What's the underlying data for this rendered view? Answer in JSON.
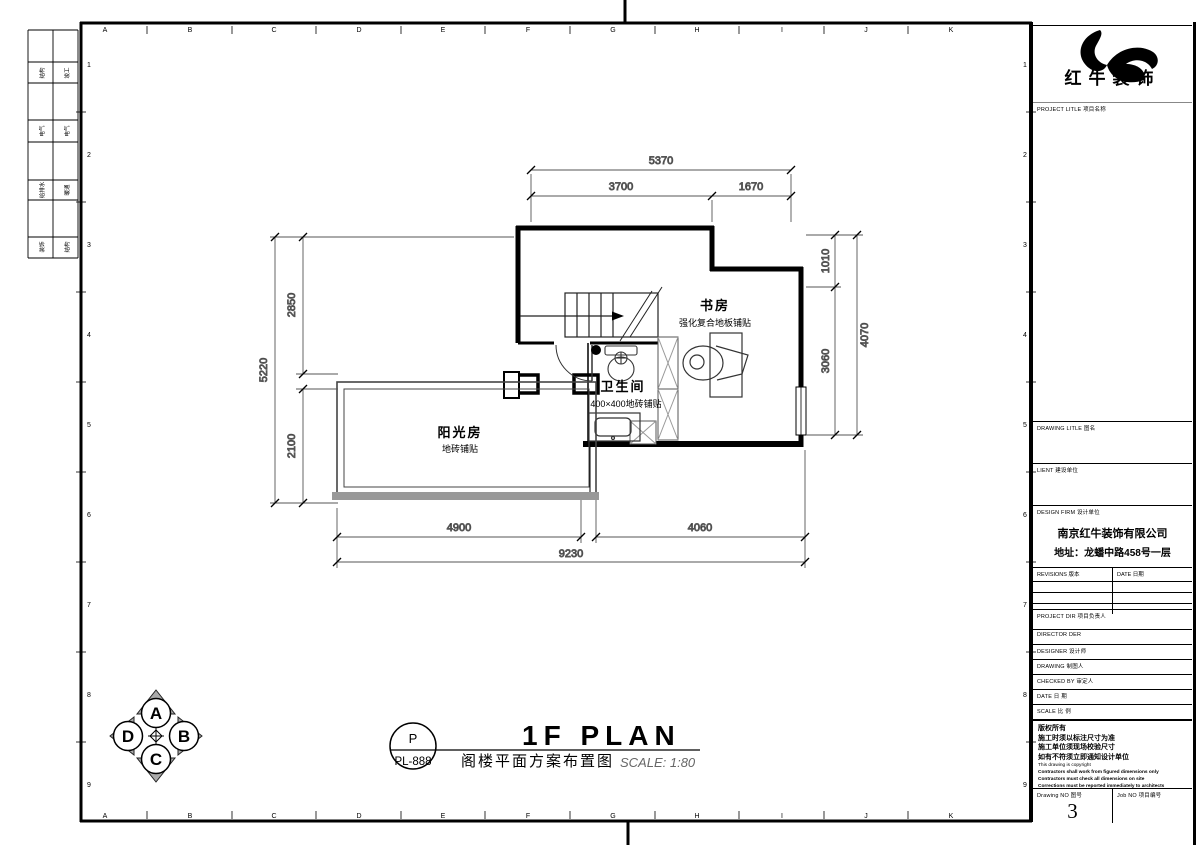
{
  "colors": {
    "wall": "#000000",
    "hatch_stroke": "#888888",
    "sun_band": "#999999",
    "compass_fill": "#aaaaaa",
    "scale_text": "#666666"
  },
  "brand": {
    "name": "红牛装饰",
    "project_title_label": "PROJECT LITLE  项目名称"
  },
  "titleblock": {
    "drawing_title_label": "DRAWING LITLE  图名",
    "client_label": "LIENT  建设单位",
    "design_firm_label": "DESIGN FIRM  设计单位",
    "design_firm_name": "南京红牛装饰有限公司",
    "design_firm_address": "地址：龙蟠中路458号一层",
    "revisions_label": "REVISIONS  版本",
    "date_col_label": "DATE  日期",
    "project_dir_label": "PROJECT DIR  项目负责人",
    "director_label": "DIRECTOR DER",
    "designer_label": "DESIGNER  设计师",
    "drawing_label": "DRAWING  制图人",
    "checked_label": "CHECKED BY  审定人",
    "date_label": "DATE  日  期",
    "scale_label": "SCALE  比  例",
    "copyright_cn": [
      "版权所有",
      "施工时须以标注尺寸为准",
      "施工单位须现场校验尺寸",
      "如有不符须立即通知设计单位"
    ],
    "copyright_en": [
      "This drawing is copyright",
      "Contractors shall work from figured dimensions only",
      "Contractors must check all dimensions on site",
      "Corrections must be reported immediately to architects"
    ],
    "drawing_no_label": "Drawing NO  图号",
    "drawing_no": "3",
    "job_no_label": "Job NO  项目编号"
  },
  "sheet": {
    "code_top": "P",
    "code_bottom": "PL-888",
    "title_en": "1F PLAN",
    "title_cn": "阁楼平面方案布置图",
    "scale": "SCALE: 1:80"
  },
  "rooms": {
    "study": {
      "name": "书房",
      "finish": "强化复合地板铺贴"
    },
    "bathroom": {
      "name": "卫生间",
      "finish": "400×400地砖铺贴"
    },
    "sunroom": {
      "name": "阳光房",
      "finish": "地砖铺贴"
    }
  },
  "dimensions": {
    "top_total": "5370",
    "top_left": "3700",
    "top_right": "1670",
    "right_upper": "1010",
    "right_lower": "3060",
    "right_total": "4070",
    "left_total": "5220",
    "left_upper": "2850",
    "left_lower": "2100",
    "bottom_left": "4900",
    "bottom_right": "4060",
    "bottom_total": "9230"
  },
  "compass": {
    "top": "A",
    "right": "B",
    "bottom": "C",
    "left": "D"
  },
  "grid": {
    "letters": [
      "A",
      "B",
      "C",
      "D",
      "E",
      "F",
      "G",
      "H",
      "I",
      "J",
      "K"
    ],
    "numbers": [
      "1",
      "2",
      "3",
      "4",
      "5",
      "6",
      "7",
      "8",
      "9"
    ]
  },
  "side_table": {
    "rows": [
      [
        "结构",
        "竣工"
      ],
      [
        "电气",
        "电气"
      ],
      [
        "给排水",
        "暖通"
      ],
      [
        "装饰",
        "结构"
      ]
    ]
  }
}
